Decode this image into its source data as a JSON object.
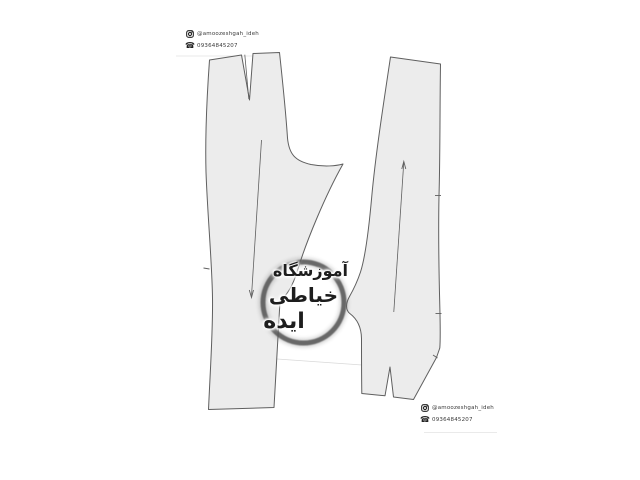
{
  "colors": {
    "background": "#ffffff",
    "piece_fill": "#ececec",
    "piece_outline": "#5f5f5f",
    "guide_line": "#d9d9d9",
    "ring": "#545454",
    "watermark_text": "#1d1d1d",
    "stamp_text": "#3a3a3a",
    "stamp_icon": "#222222"
  },
  "watermark": {
    "line1": "آموزشگاه",
    "line2": "خیاطی",
    "line3": "ایده"
  },
  "stamp": {
    "instagram_handle": "@amoozeshgah_ideh",
    "phone_number": "09364845207"
  }
}
